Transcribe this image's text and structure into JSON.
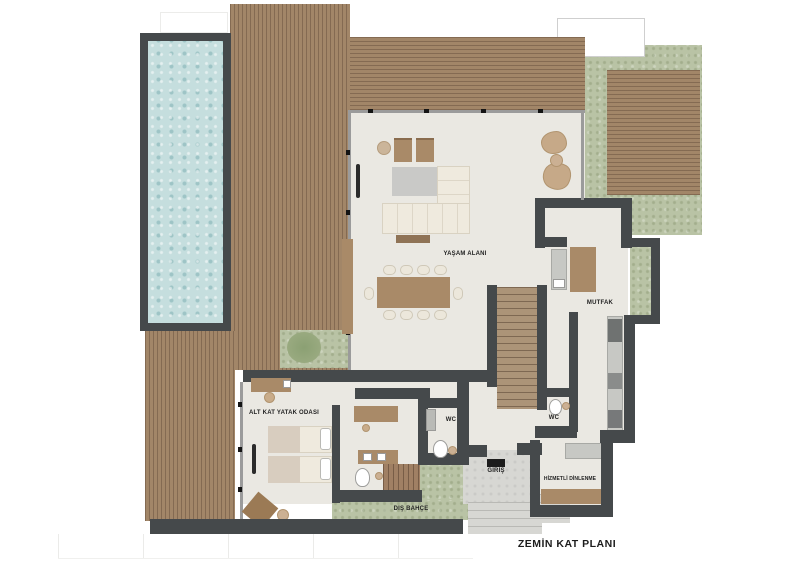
{
  "title": "ZEMİN KAT PLANI",
  "rooms": [
    {
      "name": "living-area",
      "label": "YAŞAM ALANI"
    },
    {
      "name": "kitchen",
      "label": "MUTFAK"
    },
    {
      "name": "bedroom",
      "label": "ALT KAT YATAK ODASI"
    },
    {
      "name": "wc-bedroom",
      "label": "WC"
    },
    {
      "name": "wc-kitchen",
      "label": "WC"
    },
    {
      "name": "entrance",
      "label": "GİRİŞ"
    },
    {
      "name": "staff-room",
      "label": "HİZMETLİ DİNLENME"
    },
    {
      "name": "outdoor-garden",
      "label": "DIŞ BAHÇE"
    }
  ],
  "colors": {
    "wall": "#45494b",
    "deck_wood": "#a28668",
    "grass": "#b9c3a5",
    "pool_water": "#c5dede",
    "interior_floor": "#eae8e2",
    "furniture_wood": "#a98a68",
    "upholstery_cream": "#efeade",
    "concrete_path": "#d7d7d3"
  }
}
